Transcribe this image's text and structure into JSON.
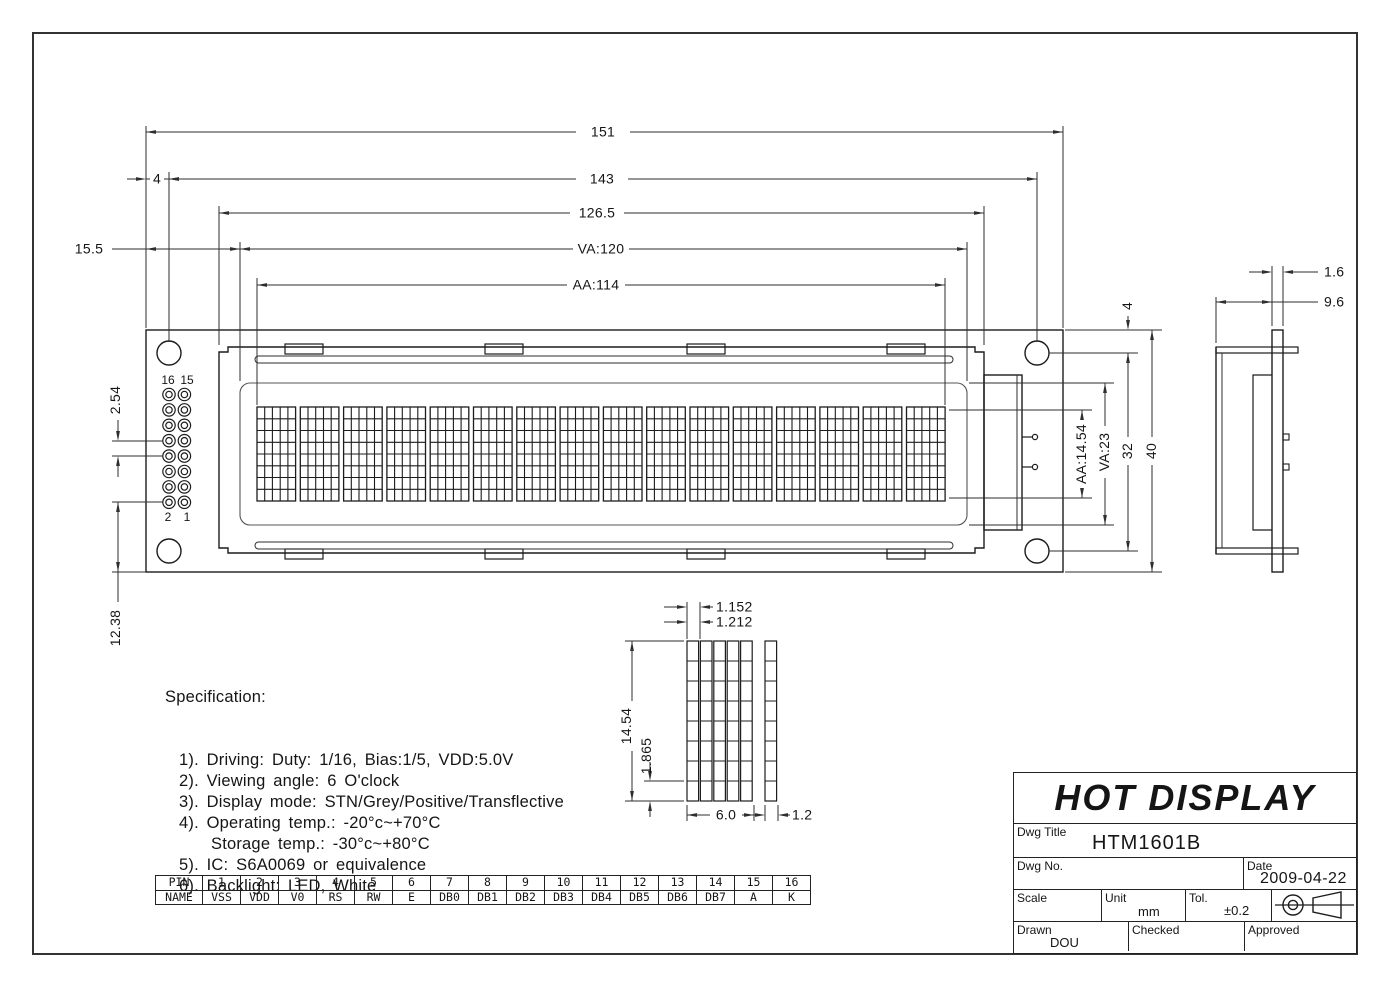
{
  "drawing": {
    "dims": {
      "len151": "151",
      "len143": "143",
      "len126_5": "126.5",
      "va120": "VA:120",
      "aa114": "AA:114",
      "off15_5": "15.5",
      "off4_left": "4",
      "pitch2_54": "2.54",
      "off12_38": "12.38",
      "aa_h": "AA:14.54",
      "va_h": "VA:23",
      "hole_off4": "4",
      "h32": "32",
      "h40": "40",
      "thk1_6": "1.6",
      "depth9_6": "9.6",
      "px_w": "1.152",
      "px_pitch": "1.212",
      "char_h": "14.54",
      "px_h": "1.865",
      "char_w": "6.0",
      "cursor_w": "1.2"
    },
    "pin_labels": {
      "p16": "16",
      "p15": "15",
      "p2": "2",
      "p1": "1"
    },
    "geometry_notes": {
      "characters": 16,
      "char_cols": 5,
      "char_rows": 8,
      "pin_rows": 8,
      "pin_cols": 2
    }
  },
  "spec": {
    "title": "Specification:",
    "items": [
      {
        "text": "1). Driving: Duty: 1/16, Bias:1/5, VDD:5.0V",
        "indent": 1
      },
      {
        "text": "2). Viewing angle: 6 O'clock",
        "indent": 1
      },
      {
        "text": "3). Display mode: STN/Grey/Positive/Transflective",
        "indent": 1
      },
      {
        "text": "4). Operating temp.: -20°c~+70°C",
        "indent": 1
      },
      {
        "text": "Storage temp.: -30°c~+80°C",
        "indent": 2
      },
      {
        "text": "5). IC: S6A0069 or equivalence",
        "indent": 1
      },
      {
        "text": "6). Backlight: LED, White",
        "indent": 1
      }
    ]
  },
  "pin_table": {
    "header_pin": "PIN",
    "header_name": "NAME",
    "pins": [
      "1",
      "2",
      "3",
      "4",
      "5",
      "6",
      "7",
      "8",
      "9",
      "10",
      "11",
      "12",
      "13",
      "14",
      "15",
      "16"
    ],
    "names": [
      "VSS",
      "VDD",
      "V0",
      "RS",
      "RW",
      "E",
      "DB0",
      "DB1",
      "DB2",
      "DB3",
      "DB4",
      "DB5",
      "DB6",
      "DB7",
      "A",
      "K"
    ]
  },
  "title_block": {
    "company": "HOT DISPLAY",
    "dwg_title_label": "Dwg Title",
    "dwg_title": "HTM1601B",
    "dwg_no_label": "Dwg No.",
    "date_label": "Date",
    "date": "2009-04-22",
    "scale_label": "Scale",
    "unit_label": "Unit",
    "unit_value": "mm",
    "tol_label": "Tol.",
    "tol_value": "±0.2",
    "drawn_label": "Drawn",
    "drawn_value": "DOU",
    "checked_label": "Checked",
    "approved_label": "Approved"
  },
  "colors": {
    "line": "#1c1c1c",
    "thin": "#2e2e2e",
    "light": "#555555",
    "paper": "#ffffff"
  }
}
